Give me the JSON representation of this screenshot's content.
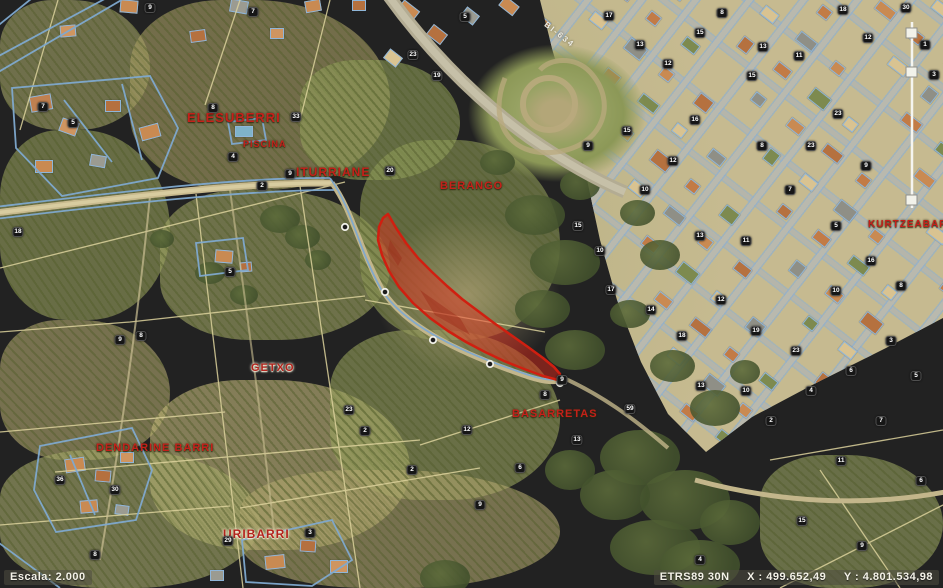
{
  "map": {
    "highlighted_parcel": {
      "fill": "#e02819",
      "border": "#d01f10"
    },
    "cadastral_line_color": "#7fa9cf",
    "place_labels": [
      {
        "id": "elesuberri",
        "text": "ELESUBERRI",
        "x": 187,
        "y": 110,
        "size": 13,
        "halo": "dark"
      },
      {
        "id": "piscina",
        "text": "PISCINA",
        "x": 243,
        "y": 139,
        "size": 9,
        "halo": "dark"
      },
      {
        "id": "iturriane",
        "text": "ITURRIANE",
        "x": 296,
        "y": 165,
        "size": 12,
        "halo": "dark"
      },
      {
        "id": "berango",
        "text": "BERANGO",
        "x": 440,
        "y": 180,
        "size": 11,
        "halo": "dark"
      },
      {
        "id": "getxo",
        "text": "GETXO",
        "x": 251,
        "y": 362,
        "size": 11,
        "halo": "light"
      },
      {
        "id": "basarretas",
        "text": "BASARRETAS",
        "x": 512,
        "y": 408,
        "size": 11,
        "halo": "dark"
      },
      {
        "id": "dendarine-barri",
        "text": "DENDARINE BARRI",
        "x": 96,
        "y": 442,
        "size": 11,
        "halo": "dark"
      },
      {
        "id": "uribarri",
        "text": "URIBARRI",
        "x": 223,
        "y": 527,
        "size": 12,
        "halo": "light"
      },
      {
        "id": "kurtzeabarri",
        "text": "KURTZEABARRI",
        "x": 868,
        "y": 219,
        "size": 10,
        "halo": "dark"
      }
    ],
    "road_label": {
      "text": "BI-634",
      "x": 548,
      "y": 20,
      "angle": 38
    },
    "parcel_markers": [
      {
        "n": "9",
        "x": 150,
        "y": 8
      },
      {
        "n": "7",
        "x": 253,
        "y": 12
      },
      {
        "n": "5",
        "x": 465,
        "y": 17
      },
      {
        "n": "23",
        "x": 413,
        "y": 55
      },
      {
        "n": "19",
        "x": 437,
        "y": 76
      },
      {
        "n": "8",
        "x": 213,
        "y": 108
      },
      {
        "n": "33",
        "x": 296,
        "y": 117
      },
      {
        "n": "7",
        "x": 43,
        "y": 107
      },
      {
        "n": "5",
        "x": 73,
        "y": 123
      },
      {
        "n": "4",
        "x": 233,
        "y": 157
      },
      {
        "n": "2",
        "x": 262,
        "y": 186
      },
      {
        "n": "9",
        "x": 290,
        "y": 174
      },
      {
        "n": "20",
        "x": 390,
        "y": 171
      },
      {
        "n": "18",
        "x": 18,
        "y": 232
      },
      {
        "n": "5",
        "x": 230,
        "y": 272
      },
      {
        "n": "9",
        "x": 120,
        "y": 340
      },
      {
        "n": "8",
        "x": 141,
        "y": 336
      },
      {
        "n": "36",
        "x": 60,
        "y": 480
      },
      {
        "n": "30",
        "x": 115,
        "y": 490
      },
      {
        "n": "8",
        "x": 95,
        "y": 555
      },
      {
        "n": "29",
        "x": 228,
        "y": 541
      },
      {
        "n": "3",
        "x": 310,
        "y": 533
      },
      {
        "n": "23",
        "x": 349,
        "y": 410
      },
      {
        "n": "2",
        "x": 365,
        "y": 431
      },
      {
        "n": "2",
        "x": 412,
        "y": 470
      },
      {
        "n": "12",
        "x": 467,
        "y": 430
      },
      {
        "n": "9",
        "x": 480,
        "y": 505
      },
      {
        "n": "6",
        "x": 520,
        "y": 468
      },
      {
        "n": "8",
        "x": 545,
        "y": 395
      },
      {
        "n": "9",
        "x": 562,
        "y": 380
      },
      {
        "n": "13",
        "x": 577,
        "y": 440
      },
      {
        "n": "59",
        "x": 630,
        "y": 409
      },
      {
        "n": "17",
        "x": 609,
        "y": 16
      },
      {
        "n": "13",
        "x": 640,
        "y": 45
      },
      {
        "n": "15",
        "x": 700,
        "y": 33
      },
      {
        "n": "8",
        "x": 722,
        "y": 13
      },
      {
        "n": "18",
        "x": 843,
        "y": 10
      },
      {
        "n": "30",
        "x": 906,
        "y": 8
      },
      {
        "n": "1",
        "x": 925,
        "y": 45
      },
      {
        "n": "3",
        "x": 934,
        "y": 75
      },
      {
        "n": "13",
        "x": 763,
        "y": 47
      },
      {
        "n": "11",
        "x": 799,
        "y": 56
      },
      {
        "n": "15",
        "x": 752,
        "y": 76
      },
      {
        "n": "23",
        "x": 838,
        "y": 114
      },
      {
        "n": "12",
        "x": 868,
        "y": 38
      },
      {
        "n": "9",
        "x": 588,
        "y": 146
      },
      {
        "n": "15",
        "x": 627,
        "y": 131
      },
      {
        "n": "12",
        "x": 673,
        "y": 161
      },
      {
        "n": "10",
        "x": 645,
        "y": 190
      },
      {
        "n": "13",
        "x": 700,
        "y": 236
      },
      {
        "n": "15",
        "x": 578,
        "y": 226
      },
      {
        "n": "10",
        "x": 600,
        "y": 251
      },
      {
        "n": "17",
        "x": 611,
        "y": 290
      },
      {
        "n": "14",
        "x": 651,
        "y": 310
      },
      {
        "n": "18",
        "x": 682,
        "y": 336
      },
      {
        "n": "12",
        "x": 721,
        "y": 300
      },
      {
        "n": "11",
        "x": 746,
        "y": 241
      },
      {
        "n": "8",
        "x": 762,
        "y": 146
      },
      {
        "n": "7",
        "x": 790,
        "y": 190
      },
      {
        "n": "23",
        "x": 811,
        "y": 146
      },
      {
        "n": "9",
        "x": 866,
        "y": 166
      },
      {
        "n": "5",
        "x": 836,
        "y": 226
      },
      {
        "n": "16",
        "x": 871,
        "y": 261
      },
      {
        "n": "8",
        "x": 901,
        "y": 286
      },
      {
        "n": "10",
        "x": 836,
        "y": 291
      },
      {
        "n": "19",
        "x": 756,
        "y": 331
      },
      {
        "n": "23",
        "x": 796,
        "y": 351
      },
      {
        "n": "10",
        "x": 746,
        "y": 391
      },
      {
        "n": "13",
        "x": 701,
        "y": 386
      },
      {
        "n": "2",
        "x": 771,
        "y": 421
      },
      {
        "n": "4",
        "x": 811,
        "y": 391
      },
      {
        "n": "6",
        "x": 851,
        "y": 371
      },
      {
        "n": "3",
        "x": 891,
        "y": 341
      },
      {
        "n": "5",
        "x": 916,
        "y": 376
      },
      {
        "n": "7",
        "x": 881,
        "y": 421
      },
      {
        "n": "11",
        "x": 841,
        "y": 461
      },
      {
        "n": "16",
        "x": 695,
        "y": 120
      },
      {
        "n": "12",
        "x": 668,
        "y": 64
      },
      {
        "n": "15",
        "x": 802,
        "y": 521
      },
      {
        "n": "9",
        "x": 862,
        "y": 546
      },
      {
        "n": "6",
        "x": 921,
        "y": 481
      },
      {
        "n": "4",
        "x": 700,
        "y": 560
      }
    ]
  },
  "statusbar": {
    "scale_label": "Escala: 2.000",
    "crs": "ETRS89 30N",
    "x_coord": "X : 499.652,49",
    "y_coord": "Y : 4.801.534,98"
  }
}
